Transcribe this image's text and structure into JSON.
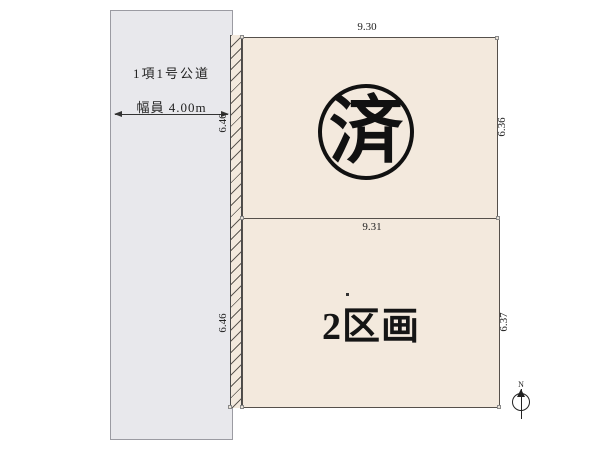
{
  "title": "区画図",
  "road": {
    "name": "1項1号公道",
    "width_label": "幅員 4.00m"
  },
  "plots": {
    "plot1": {
      "status_stamp": "済",
      "dims": {
        "top": "9.30",
        "right": "6.36",
        "left": "6.46"
      }
    },
    "plot2": {
      "label": "2区画",
      "dims": {
        "top": "9.31",
        "right": "6.37",
        "left": "6.46"
      }
    }
  },
  "compass": {
    "north_label": "N"
  },
  "colors": {
    "plot_fill": "#f3e9dd",
    "road_fill": "#e8e8ec",
    "outline": "#55504b",
    "stamp": "#111111"
  }
}
